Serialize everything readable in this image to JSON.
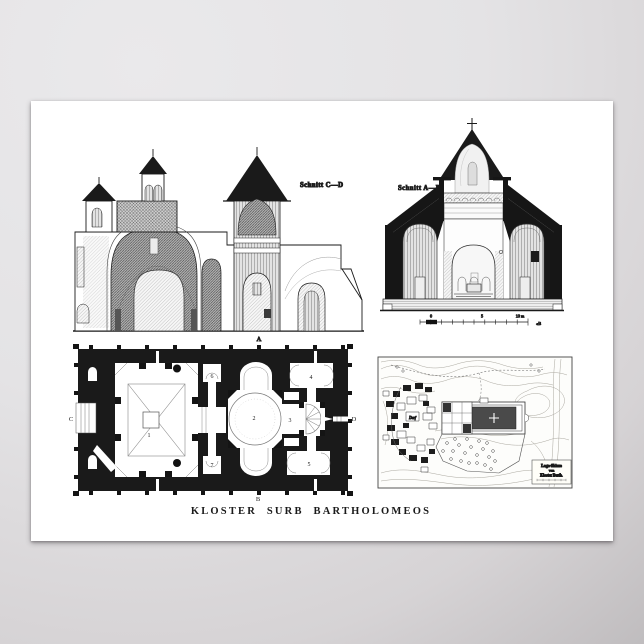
{
  "poster": {
    "caption": "KLOSTER SURB BARTHOLOMEOS",
    "sections": {
      "cd_label": "Schnitt C—D",
      "ab_label": "Schnitt A—B"
    },
    "scale_bar": {
      "zero": "0",
      "five": "5",
      "ten": "10 m",
      "direction": "«B"
    },
    "plan": {
      "room_1": "1",
      "room_2": "2",
      "room_3": "3",
      "room_4": "4",
      "room_5": "5",
      "room_6": "6",
      "room_7": "7",
      "axis_top": "A",
      "axis_bottom": "B",
      "axis_left": "C",
      "axis_right": "D"
    },
    "map": {
      "village_label": "Dorf",
      "cartouche_line1": "Lage-Skizze",
      "cartouche_line2": "vom",
      "cartouche_line3": "Kloster Barth."
    },
    "colors": {
      "ink": "#1a1a1a",
      "paper": "#ffffff",
      "backdrop_light": "#e9e8ea",
      "backdrop_dark": "#b8b5b7"
    }
  }
}
